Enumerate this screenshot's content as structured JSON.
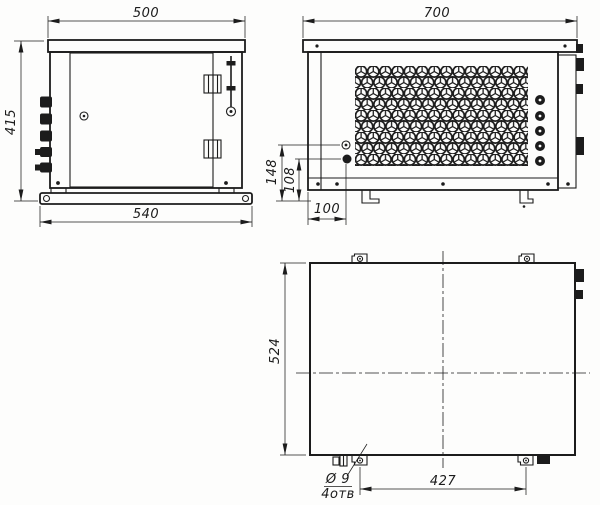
{
  "drawing": {
    "background_color": "#fdfdfc",
    "line_color": "#1c1c1c",
    "front_view": {
      "dim_width_top": "500",
      "dim_height_left": "415",
      "dim_base_width": "540"
    },
    "side_view": {
      "dim_width_top": "700",
      "dim_hole_upper_height": "148",
      "dim_hole_lower_height": "108",
      "dim_hole_offset": "100"
    },
    "plan_view": {
      "dim_depth_left": "524",
      "dim_mount_hole_spacing": "427",
      "hole_callout_diameter": "Ø 9",
      "hole_callout_count": "4отв"
    }
  }
}
